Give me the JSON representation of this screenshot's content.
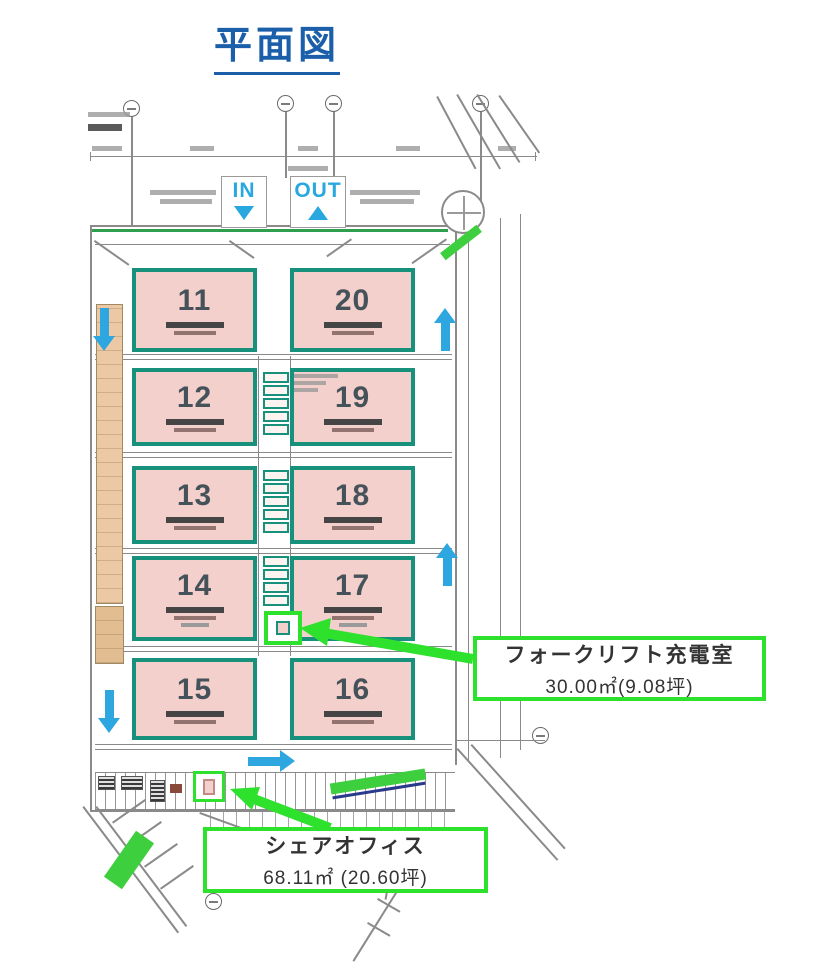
{
  "page_title": "平面図",
  "plan": {
    "gate": {
      "in_label": "IN",
      "out_label": "OUT"
    },
    "units": [
      {
        "label": "11"
      },
      {
        "label": "20"
      },
      {
        "label": "12"
      },
      {
        "label": "19"
      },
      {
        "label": "13"
      },
      {
        "label": "18"
      },
      {
        "label": "14"
      },
      {
        "label": "17"
      },
      {
        "label": "15"
      },
      {
        "label": "16"
      }
    ],
    "callouts": {
      "forklift": {
        "title": "フォークリフト充電室",
        "area": "30.00㎡(9.08坪)"
      },
      "share_office": {
        "title": "シェアオフィス",
        "area": "68.11㎡ (20.60坪)"
      }
    },
    "colors": {
      "highlight_green": "#2de12d",
      "unit_border_teal": "#17907c",
      "unit_fill_pink": "#f4d0cc",
      "arrow_blue": "#2ea7e0",
      "title_blue": "#1b5faa"
    }
  }
}
